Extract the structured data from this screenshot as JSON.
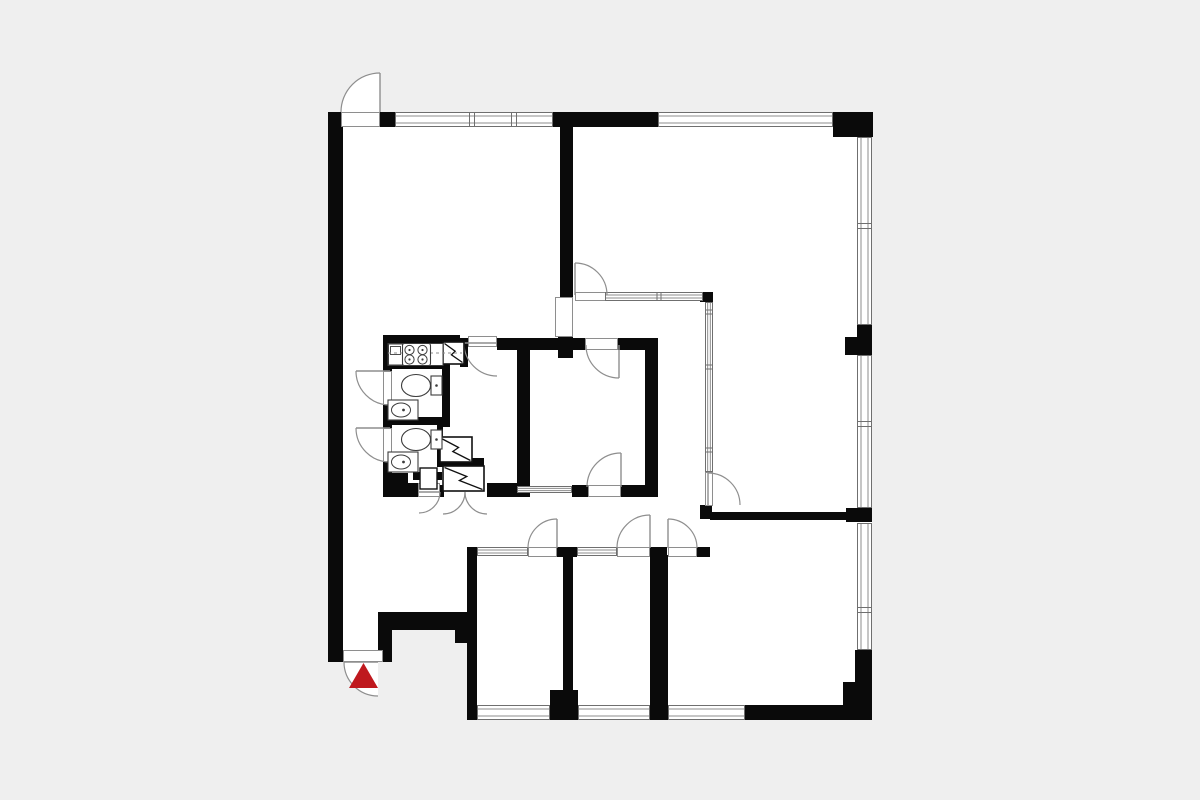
{
  "canvas": {
    "width": 1200,
    "height": 800,
    "background": "#efefef",
    "floor_fill": "#ffffff",
    "wall_color": "#0a0a0a",
    "thin_line": "#8e8e8e",
    "edge_line": "#6f6f6f",
    "fixture_line": "#3c3c3c",
    "shaft_line": "#111111",
    "accent_red": "#bf191e"
  },
  "floorplan": {
    "footprint": [
      [
        328,
        112
      ],
      [
        872,
        112
      ],
      [
        872,
        720
      ],
      [
        467,
        720
      ],
      [
        467,
        630
      ],
      [
        392,
        630
      ],
      [
        392,
        662
      ],
      [
        328,
        662
      ]
    ],
    "walls": [
      [
        328,
        112,
        15,
        550
      ],
      [
        380,
        112,
        15,
        15
      ],
      [
        553,
        112,
        105,
        15
      ],
      [
        833,
        112,
        40,
        25
      ],
      [
        857,
        325,
        15,
        30
      ],
      [
        845,
        337,
        12,
        18
      ],
      [
        846,
        508,
        26,
        14
      ],
      [
        855,
        650,
        17,
        70
      ],
      [
        843,
        682,
        14,
        25
      ],
      [
        745,
        705,
        127,
        15
      ],
      [
        550,
        690,
        28,
        30
      ],
      [
        467,
        547,
        10,
        173
      ],
      [
        563,
        557,
        10,
        133
      ],
      [
        650,
        555,
        18,
        165
      ],
      [
        710,
        512,
        140,
        8
      ],
      [
        700,
        505,
        12,
        14
      ],
      [
        697,
        547,
        13,
        10
      ],
      [
        650,
        547,
        17,
        10
      ],
      [
        557,
        547,
        20,
        10
      ],
      [
        378,
        612,
        89,
        18
      ],
      [
        378,
        630,
        14,
        32
      ],
      [
        455,
        623,
        12,
        20
      ],
      [
        560,
        127,
        13,
        170
      ],
      [
        558,
        337,
        15,
        21
      ],
      [
        700,
        292,
        13,
        10
      ],
      [
        497,
        338,
        20,
        12
      ],
      [
        517,
        338,
        68,
        12
      ],
      [
        618,
        338,
        40,
        12
      ],
      [
        517,
        338,
        13,
        159
      ],
      [
        645,
        338,
        13,
        159
      ],
      [
        572,
        485,
        16,
        12
      ],
      [
        621,
        485,
        37,
        12
      ],
      [
        517,
        485,
        5,
        12
      ],
      [
        383,
        335,
        77,
        9
      ],
      [
        460,
        338,
        8,
        29
      ],
      [
        383,
        335,
        9,
        36
      ],
      [
        383,
        405,
        9,
        23
      ],
      [
        383,
        462,
        9,
        35
      ],
      [
        383,
        473,
        25,
        24
      ],
      [
        383,
        362,
        67,
        7
      ],
      [
        383,
        417,
        59,
        8
      ],
      [
        442,
        367,
        8,
        60
      ],
      [
        413,
        472,
        29,
        8
      ],
      [
        437,
        425,
        6,
        38
      ],
      [
        437,
        458,
        47,
        9
      ],
      [
        408,
        483,
        10,
        14
      ],
      [
        440,
        485,
        4,
        12
      ],
      [
        487,
        483,
        30,
        14
      ]
    ],
    "windows": [
      {
        "x": 395,
        "y": 112,
        "w": 158,
        "h": 15,
        "dir": "h",
        "mullions": [
          472,
          514
        ]
      },
      {
        "x": 658,
        "y": 112,
        "w": 175,
        "h": 15,
        "dir": "h",
        "mullions": []
      },
      {
        "x": 857,
        "y": 137,
        "w": 15,
        "h": 188,
        "dir": "v",
        "mullions": [
          226
        ]
      },
      {
        "x": 857,
        "y": 355,
        "w": 15,
        "h": 153,
        "dir": "v",
        "mullions": [
          424
        ]
      },
      {
        "x": 857,
        "y": 523,
        "w": 15,
        "h": 127,
        "dir": "v",
        "mullions": [
          610
        ]
      },
      {
        "x": 477,
        "y": 705,
        "w": 73,
        "h": 15,
        "dir": "h",
        "mullions": []
      },
      {
        "x": 578,
        "y": 705,
        "w": 72,
        "h": 15,
        "dir": "h",
        "mullions": []
      },
      {
        "x": 668,
        "y": 705,
        "w": 77,
        "h": 15,
        "dir": "h",
        "mullions": []
      }
    ],
    "glazing": [
      {
        "x": 605,
        "y": 292,
        "w": 98,
        "h": 9,
        "dir": "h",
        "mullions": [
          659
        ]
      },
      {
        "x": 705,
        "y": 302,
        "w": 8,
        "h": 170,
        "dir": "v",
        "mullions": [
          312,
          367,
          450
        ]
      },
      {
        "x": 517,
        "y": 486,
        "w": 55,
        "h": 7,
        "dir": "h",
        "mullions": []
      },
      {
        "x": 477,
        "y": 547,
        "w": 51,
        "h": 9,
        "dir": "h",
        "mullions": []
      },
      {
        "x": 577,
        "y": 547,
        "w": 40,
        "h": 9,
        "dir": "h",
        "mullions": []
      }
    ],
    "openings": [
      [
        341,
        112,
        39,
        15
      ],
      [
        343,
        650,
        40,
        12
      ],
      [
        555,
        297,
        18,
        40
      ],
      [
        468,
        336,
        29,
        11
      ],
      [
        383,
        371,
        9,
        34
      ],
      [
        383,
        428,
        9,
        34
      ],
      [
        585,
        338,
        33,
        12
      ],
      [
        588,
        485,
        33,
        12
      ],
      [
        575,
        292,
        32,
        9
      ],
      [
        528,
        547,
        29,
        10
      ],
      [
        617,
        547,
        33,
        10
      ],
      [
        668,
        547,
        29,
        10
      ],
      [
        705,
        472,
        8,
        34
      ],
      [
        418,
        483,
        22,
        14
      ]
    ],
    "doors": [
      {
        "cx": 380,
        "cy": 112,
        "r": 39,
        "a0": 180,
        "a1": 270,
        "leaf": [
          380,
          73,
          380,
          112
        ],
        "wedge": true
      },
      {
        "cx": 575,
        "cy": 295,
        "r": 32,
        "a0": 270,
        "a1": 360,
        "leaf": [
          575,
          263,
          575,
          295
        ],
        "wedge": false
      },
      {
        "cx": 497,
        "cy": 343,
        "r": 33,
        "a0": 90,
        "a1": 180,
        "leaf": [
          464,
          343,
          497,
          343
        ],
        "wedge": false
      },
      {
        "cx": 619,
        "cy": 345,
        "r": 33,
        "a0": 90,
        "a1": 180,
        "leaf": [
          619,
          345,
          619,
          378
        ],
        "wedge": false
      },
      {
        "cx": 621,
        "cy": 487,
        "r": 34,
        "a0": 180,
        "a1": 270,
        "leaf": [
          621,
          453,
          621,
          487
        ],
        "wedge": false
      },
      {
        "cx": 390,
        "cy": 371,
        "r": 34,
        "a0": 90,
        "a1": 180,
        "leaf": [
          356,
          371,
          390,
          371
        ],
        "wedge": false
      },
      {
        "cx": 390,
        "cy": 428,
        "r": 34,
        "a0": 90,
        "a1": 180,
        "leaf": [
          356,
          428,
          390,
          428
        ],
        "wedge": false
      },
      {
        "cx": 419,
        "cy": 492,
        "r": 21,
        "a0": 0,
        "a1": 90,
        "leaf": [
          419,
          492,
          440,
          492
        ],
        "wedge": false
      },
      {
        "cx": 443,
        "cy": 492,
        "r": 22,
        "a0": 0,
        "a1": 90,
        "leaf": null,
        "wedge": false
      },
      {
        "cx": 487,
        "cy": 492,
        "r": 22,
        "a0": 90,
        "a1": 180,
        "leaf": null,
        "wedge": false
      },
      {
        "cx": 557,
        "cy": 548,
        "r": 29,
        "a0": 180,
        "a1": 270,
        "leaf": [
          557,
          519,
          557,
          548
        ],
        "wedge": false
      },
      {
        "cx": 650,
        "cy": 548,
        "r": 33,
        "a0": 180,
        "a1": 270,
        "leaf": [
          650,
          515,
          650,
          548
        ],
        "wedge": false
      },
      {
        "cx": 668,
        "cy": 548,
        "r": 29,
        "a0": 270,
        "a1": 360,
        "leaf": [
          668,
          519,
          668,
          548
        ],
        "wedge": false
      },
      {
        "cx": 708,
        "cy": 505,
        "r": 32,
        "a0": 270,
        "a1": 360,
        "leaf": [
          708,
          473,
          708,
          505
        ],
        "wedge": false
      },
      {
        "cx": 378,
        "cy": 662,
        "r": 34,
        "a0": 90,
        "a1": 180,
        "leaf": [
          344,
          662,
          378,
          662
        ],
        "wedge": true
      }
    ],
    "shafts": [
      {
        "x": 443,
        "y": 342,
        "w": 21,
        "h": 22
      },
      {
        "x": 440,
        "y": 437,
        "w": 32,
        "h": 25
      },
      {
        "x": 443,
        "y": 466,
        "w": 41,
        "h": 25
      }
    ],
    "cabinets": [
      {
        "x": 420,
        "y": 468,
        "w": 17,
        "h": 21
      }
    ],
    "kitchen": {
      "counter": [
        388,
        343.5,
        55,
        22
      ],
      "unit": [
        388.5,
        344,
        14,
        21
      ],
      "unit_inner": [
        390.5,
        346.5,
        10,
        8
      ],
      "dash_line": [
        388,
        353,
        462,
        353
      ],
      "stove": {
        "x": 402.5,
        "y": 343.5,
        "w": 28,
        "h": 22,
        "burner_r": 4.6,
        "burners": [
          [
            409.5,
            350
          ],
          [
            422.5,
            350
          ],
          [
            409.5,
            359.5
          ],
          [
            422.5,
            359.5
          ]
        ]
      }
    },
    "toilets": [
      {
        "ex": 416,
        "ey": 385.5,
        "rx": 14.5,
        "ry": 11,
        "tank": [
          431,
          376,
          11,
          19
        ],
        "dot": [
          436.5,
          385.5
        ]
      },
      {
        "ex": 416,
        "ey": 439.5,
        "rx": 14.5,
        "ry": 11,
        "tank": [
          431,
          430,
          11,
          19
        ],
        "dot": [
          436.5,
          439.5
        ]
      }
    ],
    "sinks": [
      {
        "rect": [
          388,
          400,
          30,
          20
        ],
        "ex": 401,
        "ey": 410,
        "rx": 9.5,
        "ry": 7,
        "dot": [
          403.5,
          410
        ]
      },
      {
        "rect": [
          388,
          452,
          30,
          20
        ],
        "ex": 401,
        "ey": 462,
        "rx": 9.5,
        "ry": 7,
        "dot": [
          403.5,
          462
        ]
      }
    ],
    "entrance_triangle": [
      [
        349,
        688
      ],
      [
        378,
        688
      ],
      [
        363.5,
        663
      ]
    ]
  }
}
